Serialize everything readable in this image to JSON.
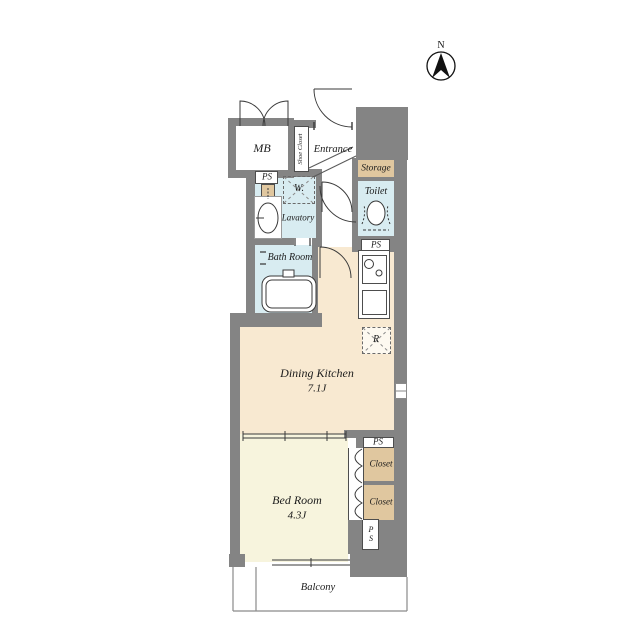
{
  "compass": {
    "north_label": "N"
  },
  "labels": {
    "mb": "MB",
    "shoe_closet": "Shoe Closet",
    "entrance": "Entrance",
    "storage": "Storage",
    "toilet": "Toilet",
    "walk_in_closet": "W.",
    "lavatory": "Lavatory",
    "bath_room": "Bath Room",
    "dining_kitchen": "Dining Kitchen",
    "dining_kitchen_size": "7.1J",
    "refrigerator": "R",
    "bed_room": "Bed Room",
    "bed_room_size": "4.3J",
    "closet_upper": "Closet",
    "closet_lower": "Closet",
    "balcony": "Balcony",
    "ps_meter": "PS",
    "ps_toilet": "PS",
    "ps_closet": "PS",
    "ps_bottom": "PS"
  },
  "colors": {
    "wall": "#848484",
    "dining_kitchen_floor": "#f8e9d1",
    "bedroom_floor": "#f7f4dd",
    "wet_area_floor": "#d8ecf1",
    "closet_fill": "#e0c79f",
    "line": "#3a3a3a"
  }
}
